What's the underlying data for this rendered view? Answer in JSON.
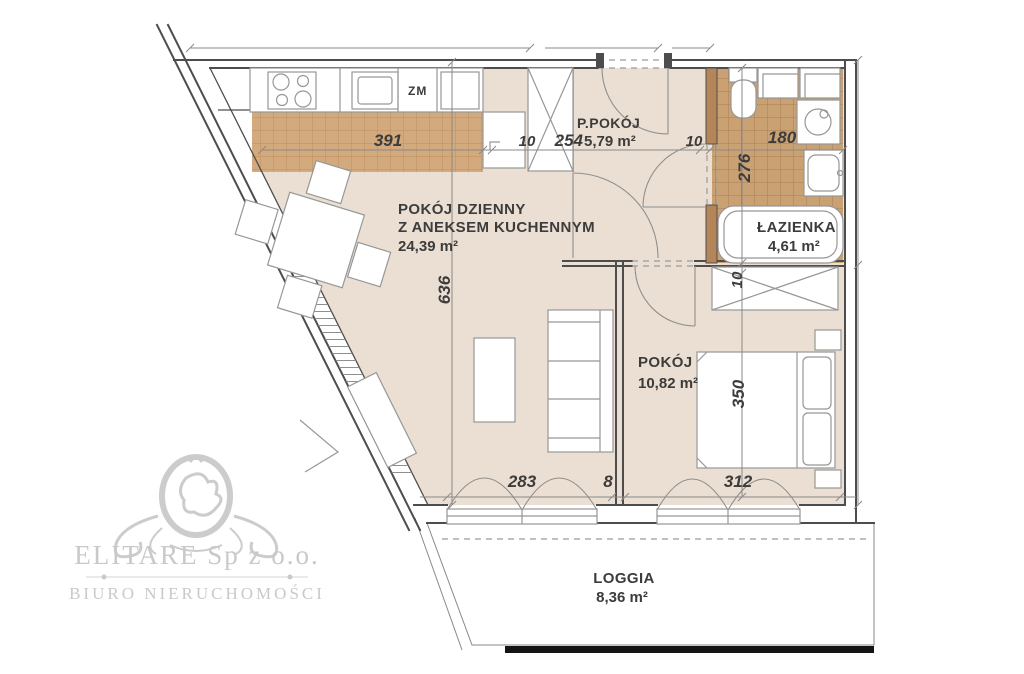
{
  "plan_title": "Apartment floor plan",
  "rooms": {
    "living": {
      "name_line1": "POKÓJ DZIENNY",
      "name_line2": "Z ANEKSEM KUCHENNYM",
      "area": "24,39 m²"
    },
    "hall": {
      "name": "P.POKÓJ",
      "area": "5,79 m²"
    },
    "bath": {
      "name": "ŁAZIENKA",
      "area": "4,61 m²"
    },
    "bedroom": {
      "name": "POKÓJ",
      "area": "10,82 m²"
    },
    "loggia": {
      "name": "LOGGIA",
      "area": "8,36 m²"
    }
  },
  "dimensions": {
    "kitchen_width": "391",
    "wall_hall_left": "10",
    "hall_width": "254",
    "wall_hall_right": "10",
    "bath_width": "180",
    "bath_height": "276",
    "living_height": "636",
    "bed_wall": "10",
    "bedroom_height": "350",
    "living_width_bottom": "283",
    "partition_thickness": "8",
    "bedroom_width_bottom": "312"
  },
  "labels": {
    "dishwasher": "ZM"
  },
  "watermark": {
    "company": "ELITARE Sp z o.o.",
    "subtitle": "BIURO NIERUCHOMOŚCI"
  },
  "colors": {
    "floor": "#EADFD2",
    "tileK": "#D3AA7D",
    "tileKline": "#BC8D5D",
    "tileB": "#C9A173",
    "tileBline": "#AC7D4F",
    "wall": "#4d4d4d",
    "furn": "#979797",
    "dim": "#8a8a8a",
    "ink": "#3c3c3c",
    "stub": "#B5855A",
    "bar": "#141414",
    "wm": "#c9c9c9"
  }
}
